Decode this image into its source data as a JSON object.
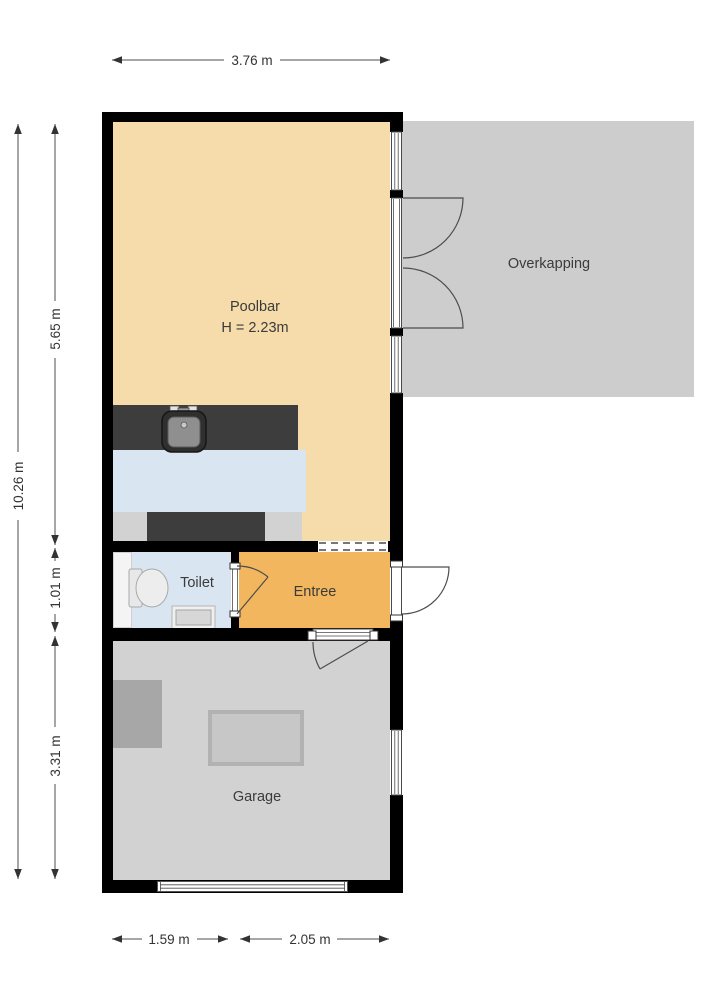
{
  "plan": {
    "rooms": {
      "poolbar": {
        "label": "Poolbar",
        "height_label": "H = 2.23m"
      },
      "overkapping": {
        "label": "Overkapping"
      },
      "toilet": {
        "label": "Toilet"
      },
      "entree": {
        "label": "Entree"
      },
      "garage": {
        "label": "Garage"
      }
    },
    "dimensions": {
      "top_width": "3.76 m",
      "total_height": "10.26 m",
      "poolbar_height": "5.65 m",
      "toilet_height": "1.01 m",
      "garage_height": "3.31 m",
      "bottom_left_width": "1.59 m",
      "bottom_right_width": "2.05 m"
    },
    "colors": {
      "background": "#ffffff",
      "wall": "#000000",
      "poolbar_floor": "#f6dcab",
      "entree_floor": "#f2b65f",
      "toilet_floor": "#d9e5f1",
      "bar_floor": "#d9e5f1",
      "overkapping_floor": "#cdcdcd",
      "garage_floor": "#d2d2d2",
      "counter": "#3d3d3d",
      "storage_box": "#a7a7a7"
    }
  }
}
